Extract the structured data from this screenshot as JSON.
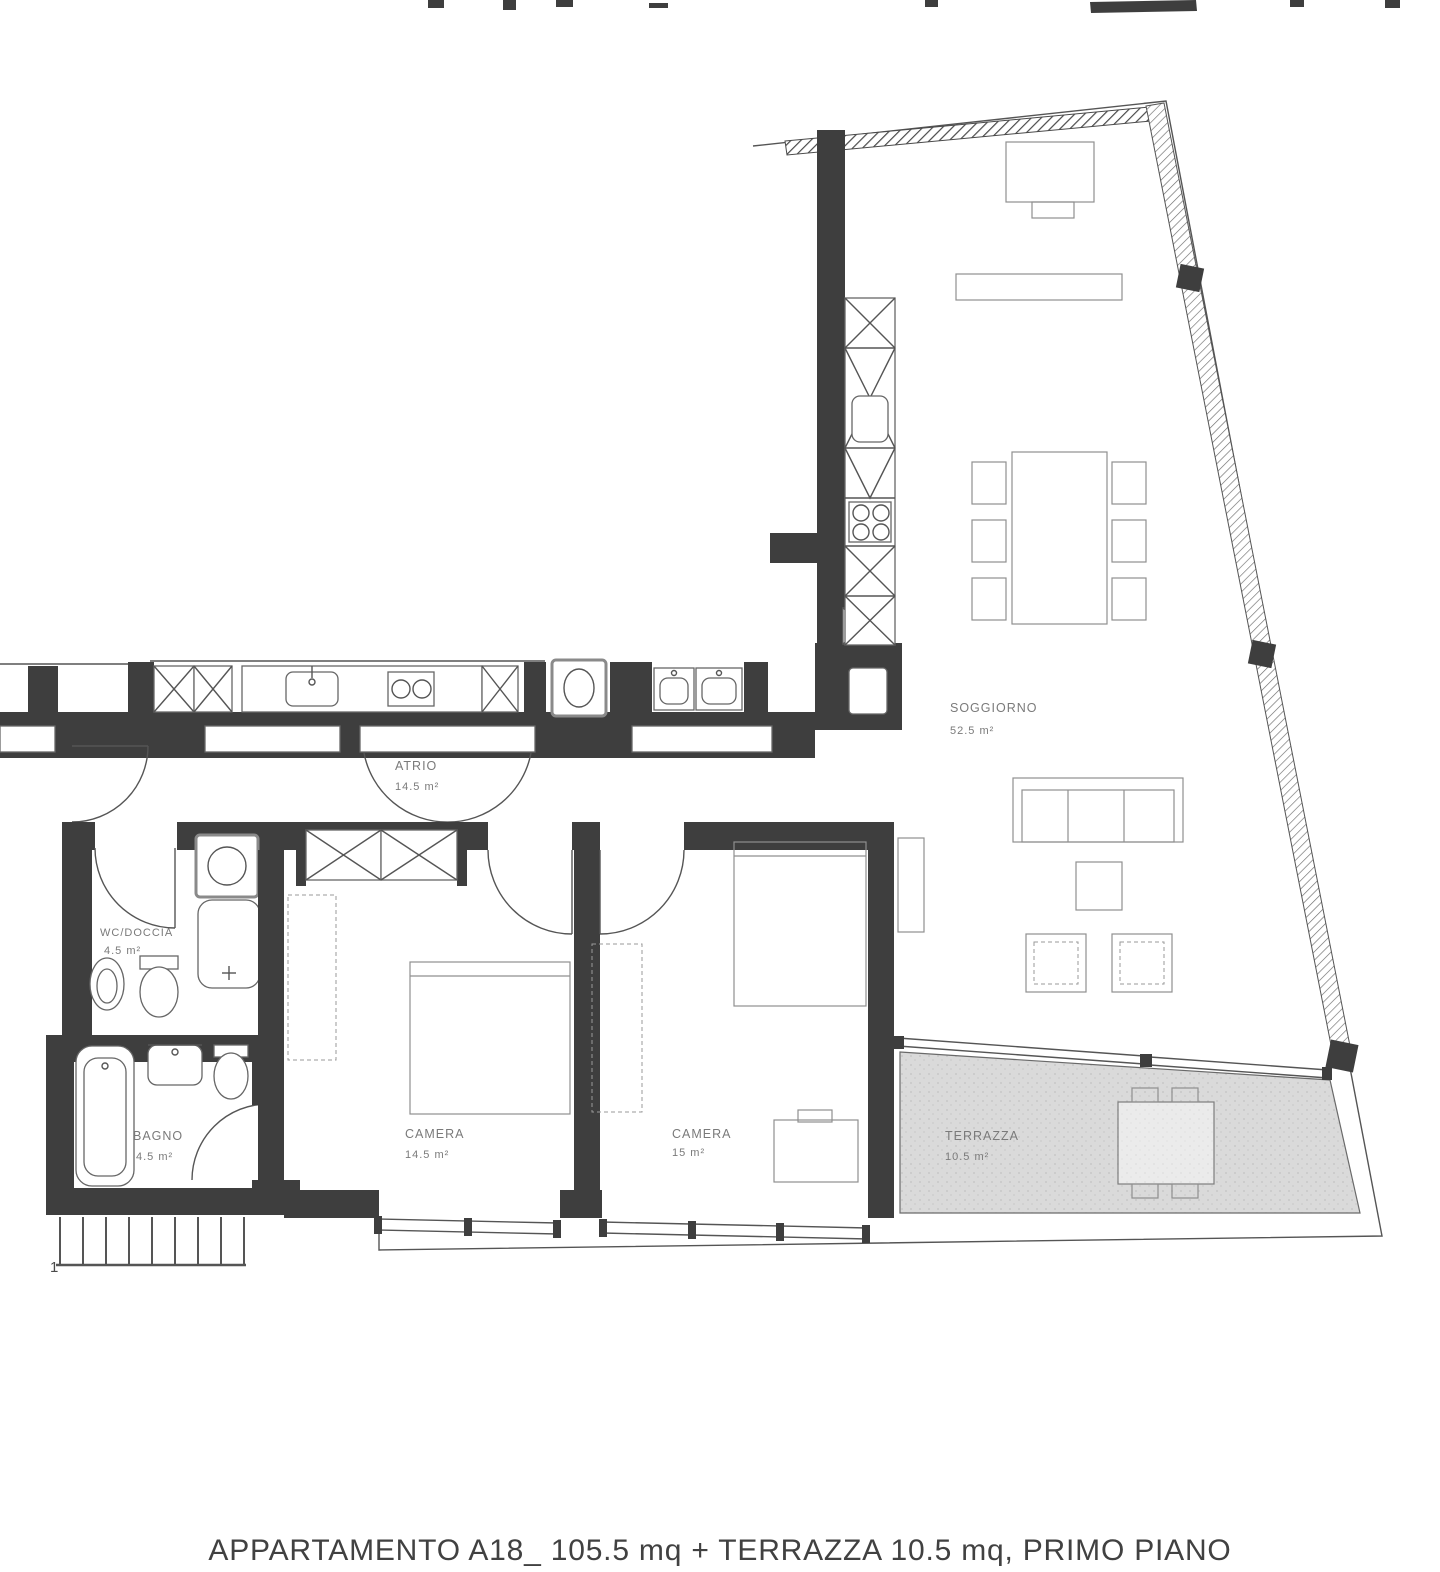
{
  "document": {
    "type": "scanned apartment floor plan",
    "caption": "APPARTAMENTO A18_ 105.5 mq + TERRAZZA 10.5 mq, PRIMO PIANO"
  },
  "rooms": [
    {
      "name": "SOGGIORNO",
      "area": "52.5 m²"
    },
    {
      "name": "ATRIO",
      "area": "14.5 m²"
    },
    {
      "name": "CAMERA",
      "area": "14.5 m²"
    },
    {
      "name": "CAMERA",
      "area": "15 m²"
    },
    {
      "name": "TERRAZZA",
      "area": "10.5 m²"
    },
    {
      "name": "BAGNO",
      "area": "4.5 m²"
    },
    {
      "name": "WC/DOCCIA",
      "area": "4.5 m²"
    }
  ],
  "annotations": {
    "stair_label": "1"
  },
  "colors": {
    "wall": "#3e3e3e",
    "line": "#555555",
    "furniture": "#8f8f8f",
    "label": "#7a7a7a",
    "terrace_fill": "#dadada",
    "paper": "#ffffff"
  }
}
